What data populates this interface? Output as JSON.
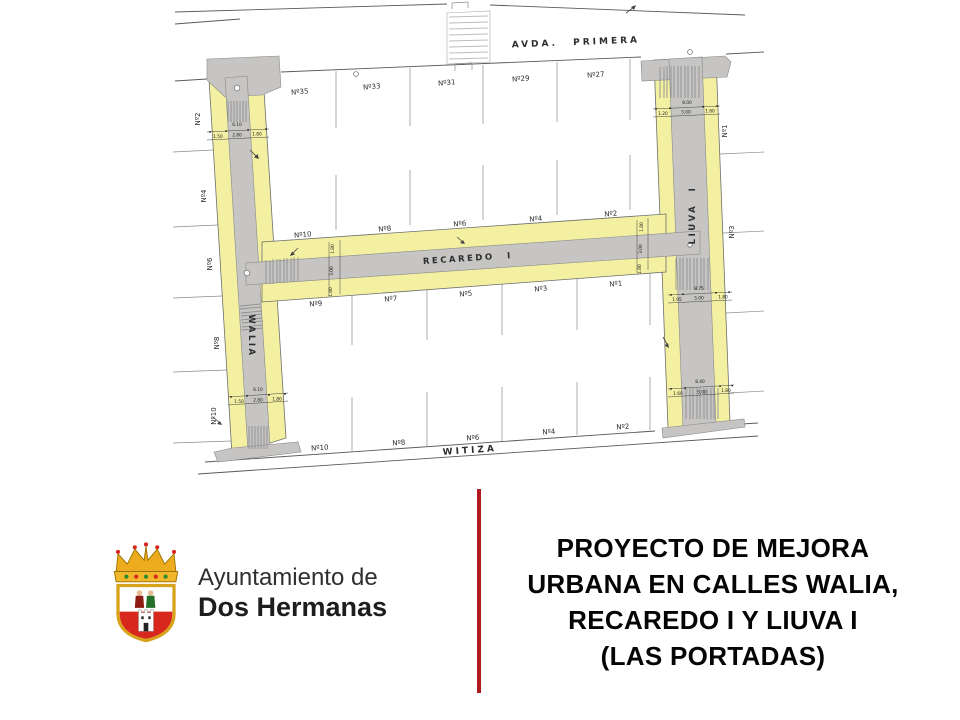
{
  "map": {
    "street_names": {
      "avda_primera": "AVDA.  PRIMERA",
      "walia": "WALIA",
      "recaredo": "RECAREDO  I",
      "liuva": "LIUVA  I",
      "witiza": "WITIZA"
    },
    "plots": {
      "avda_row": [
        "Nº35",
        "Nº33",
        "Nº31",
        "Nº29",
        "Nº27"
      ],
      "recaredo_north": [
        "Nº10",
        "Nº8",
        "Nº6",
        "Nº4",
        "Nº2"
      ],
      "recaredo_south": [
        "Nº9",
        "Nº7",
        "Nº5",
        "Nº3",
        "Nº1"
      ],
      "witiza_row": [
        "Nº10",
        "Nº8",
        "Nº6",
        "Nº4",
        "Nº2"
      ],
      "walia_side": [
        "Nº2",
        "Nº4",
        "Nº6",
        "Nº8",
        "Nº10"
      ],
      "liuva_side": [
        "Nº1",
        "Nº3"
      ]
    },
    "dimensions": {
      "walia_top": {
        "total": "6.10",
        "parts": [
          "1.50",
          "2.80",
          "1.80"
        ]
      },
      "walia_bottom": {
        "total": "6.10",
        "parts": [
          "1.50",
          "2.80",
          "1.80"
        ]
      },
      "liuva_top": {
        "total": "8.00",
        "parts": [
          "1.20",
          "5.00",
          "1.80"
        ]
      },
      "liuva_mid": {
        "total": "8.75",
        "parts": [
          "1.95",
          "5.00",
          "1.80"
        ]
      },
      "liuva_bottom": {
        "total": "8.40",
        "parts": [
          "1.60",
          "5.00",
          "1.80"
        ]
      },
      "recaredo_left": [
        "1.80",
        "3.00",
        "1.80"
      ],
      "recaredo_right": [
        "1.80",
        "3.00",
        "1.80"
      ]
    },
    "colors": {
      "sidewalk": "#f3f0a2",
      "road": "#c6c5c3"
    }
  },
  "footer": {
    "logo": {
      "org_line1": "Ayuntamiento de",
      "org_line2": "Dos Hermanas"
    },
    "divider_color": "#b11b1f",
    "title_lines": [
      "PROYECTO DE MEJORA",
      "URBANA EN CALLES WALIA,",
      "RECAREDO  I Y LIUVA I",
      "(LAS PORTADAS)"
    ]
  }
}
